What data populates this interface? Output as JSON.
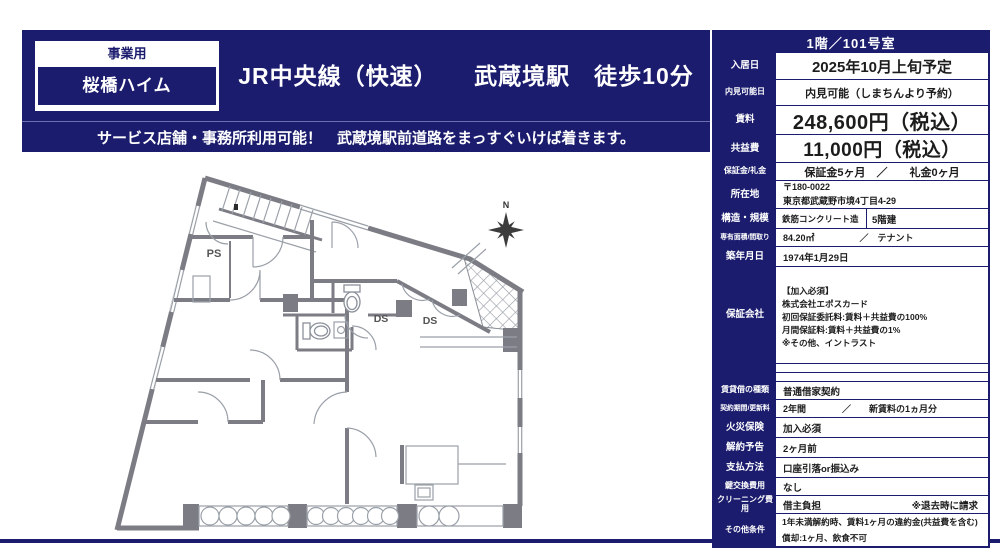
{
  "header": {
    "use_type": "事業用",
    "building_name": "桜橋ハイム",
    "title": "JR中央線（快速）　　武蔵境駅　徒歩10分",
    "subtitle": "サービス店舗・事務所利用可能！　武蔵境駅前道路をまっすぐいけば着きます。",
    "navy_color": "#1b1c6e"
  },
  "floorplan": {
    "wall_color": "#7c7c85",
    "labels": {
      "ps": "PS",
      "ds1": "DS",
      "ds2": "DS",
      "north": "N"
    }
  },
  "table": {
    "title": "1階／101号室",
    "rows": [
      {
        "label": "入居日",
        "value": "2025年10月上旬予定"
      },
      {
        "label": "内見可能日",
        "value": "内見可能（しまちんより予約）"
      },
      {
        "label": "賃料",
        "value": "248,600円（税込）"
      },
      {
        "label": "共益費",
        "value": "11,000円（税込）"
      },
      {
        "label": "保証金/礼金",
        "value": "保証金5ヶ月　／　　礼金0ヶ月"
      },
      {
        "label": "所在地",
        "line1": "〒180-0022",
        "line2": "東京都武蔵野市境4丁目4-29"
      },
      {
        "label": "構造・規模",
        "value1": "鉄筋コンクリート造",
        "value2": "5階建"
      },
      {
        "label": "専有面積/間取り",
        "value": "84.20㎡　　　　　／　テナント"
      },
      {
        "label": "築年月日",
        "value": "1974年1月29日"
      },
      {
        "label": "保証会社",
        "value": "【加入必須】\n株式会社エポスカード\n初回保証委託料:賃料＋共益費の100%\n月間保証料:賃料＋共益費の1%\n※その他、イントラスト"
      },
      {
        "label": "",
        "value": ""
      },
      {
        "label": "",
        "value": ""
      },
      {
        "label": "賃貸借の種類",
        "value": "普通借家契約"
      },
      {
        "label": "契約期間/更新料",
        "value": "2年間　　　　／　　新賃料の1ヵ月分"
      },
      {
        "label": "火災保険",
        "value": "加入必須"
      },
      {
        "label": "解約予告",
        "value": "2ヶ月前"
      },
      {
        "label": "支払方法",
        "value": "口座引落or振込み"
      },
      {
        "label": "鍵交換費用",
        "value": "なし"
      },
      {
        "label": "クリーニング費用",
        "value": "借主負担",
        "note": "※退去時に請求"
      },
      {
        "label": "その他条件",
        "line1": "1年未満解約時、賃料1ヶ月の違約金(共益費を含む)",
        "line2": "償却:1ヶ月、飲食不可"
      }
    ]
  }
}
